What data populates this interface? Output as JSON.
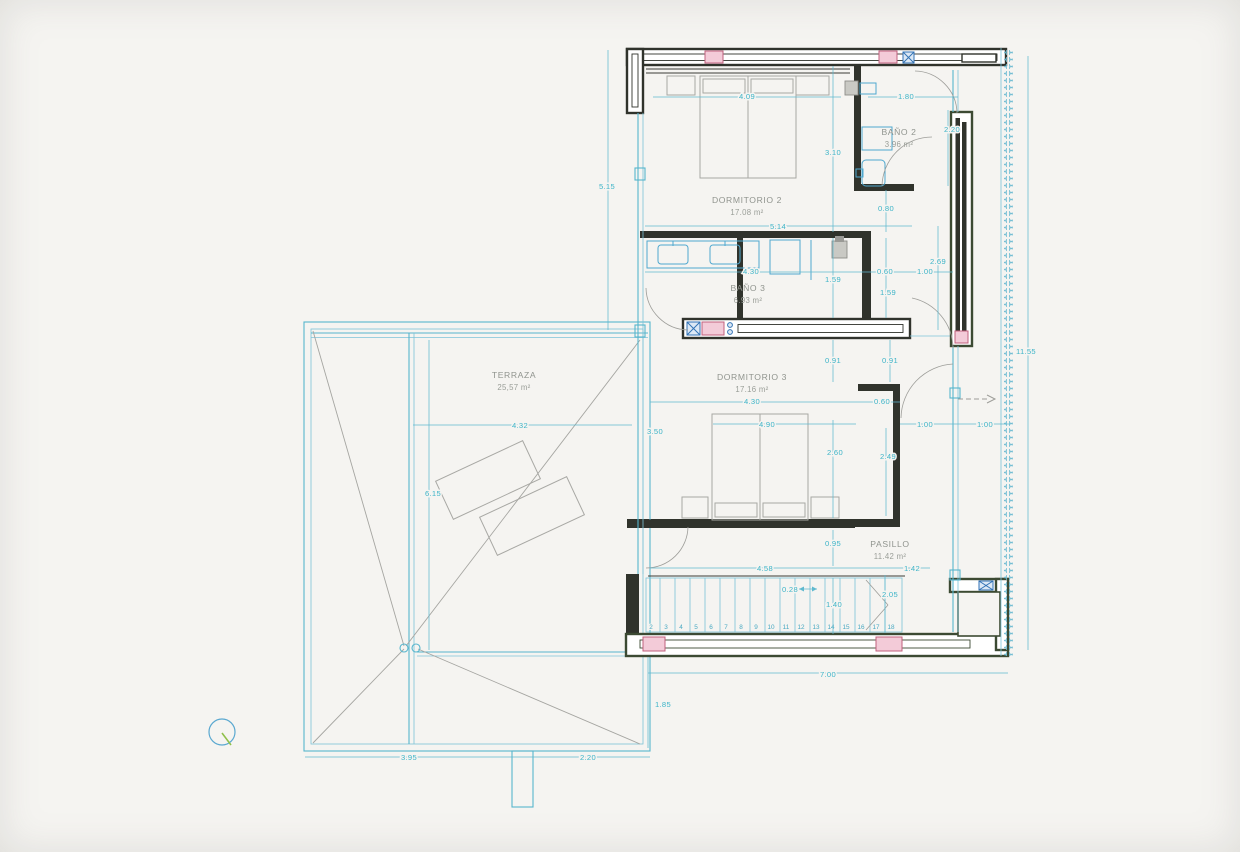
{
  "document": {
    "type": "architectural floor plan",
    "language": "es"
  },
  "colors": {
    "paper": "#f5f4f1",
    "plan_cyan": "#56b5cd",
    "dimension_text": "#3db4c8",
    "wall_dark": "#30332c",
    "wall_green": "#3c4a33",
    "column_pink_fill": "#f3cbd8",
    "column_pink_border": "#c2607e",
    "blue_marker": "#3272b5",
    "furniture_gray": "#a8a8a4",
    "room_label_gray": "#90948e",
    "north_needle_green": "#8fc04a"
  },
  "rooms": [
    {
      "id": "dormitorio2",
      "label": "DORMITORIO 2",
      "area": "17.08 m²"
    },
    {
      "id": "bano2",
      "label": "BAÑO 2",
      "area": "3.96 m²"
    },
    {
      "id": "bano3",
      "label": "BAÑO 3",
      "area": "6.93 m²"
    },
    {
      "id": "dormitorio3",
      "label": "DORMITORIO 3",
      "area": "17.16 m²"
    },
    {
      "id": "terraza",
      "label": "TERRAZA",
      "area": "25,57 m²"
    },
    {
      "id": "pasillo",
      "label": "PASILLO",
      "area": "11.42 m²"
    }
  ],
  "dims": {
    "dorm2_bed_width": "4.09",
    "bano2_width": "1.80",
    "dorm2_depth": "3.10",
    "bano2_depth": "2.20",
    "dorm2_width": "5.14",
    "bano2_door": "0.80",
    "west_facade": "5.15",
    "bano3_width": "4.30",
    "bano3_depth_left": "1.59",
    "bano3_opening": "0.60",
    "bano3_passage": "1.00",
    "bano3_east": "2.69",
    "bano3_depth_right": "1.59",
    "dorm3_top_left": "0.91",
    "dorm3_top_right": "0.91",
    "dorm3_width": "4.30",
    "dorm3_closet": "0.60",
    "dorm3_bed_width": "4.90",
    "dorm3_west": "3.50",
    "dorm3_depth": "2.60",
    "closet_depth": "2.49",
    "pasillo_width_left": "1.00",
    "pasillo_width_right": "1.00",
    "terraza_width": "4.32",
    "terraza_depth": "6.15",
    "hall_depth": "0.95",
    "stair_length": "4.58",
    "stair_tread": "0.28",
    "stair_width": "1.40",
    "stair_right": "2.05",
    "pasillo_end": "1.42",
    "south_facade": "7.00",
    "south_offset": "1.85",
    "roof_width_left": "3.95",
    "roof_width_right": "2.20",
    "east_facade": "11.55"
  },
  "stairs": {
    "steps": [
      "2",
      "3",
      "4",
      "5",
      "6",
      "7",
      "8",
      "9",
      "10",
      "11",
      "12",
      "13",
      "14",
      "15",
      "16",
      "17",
      "18"
    ]
  }
}
